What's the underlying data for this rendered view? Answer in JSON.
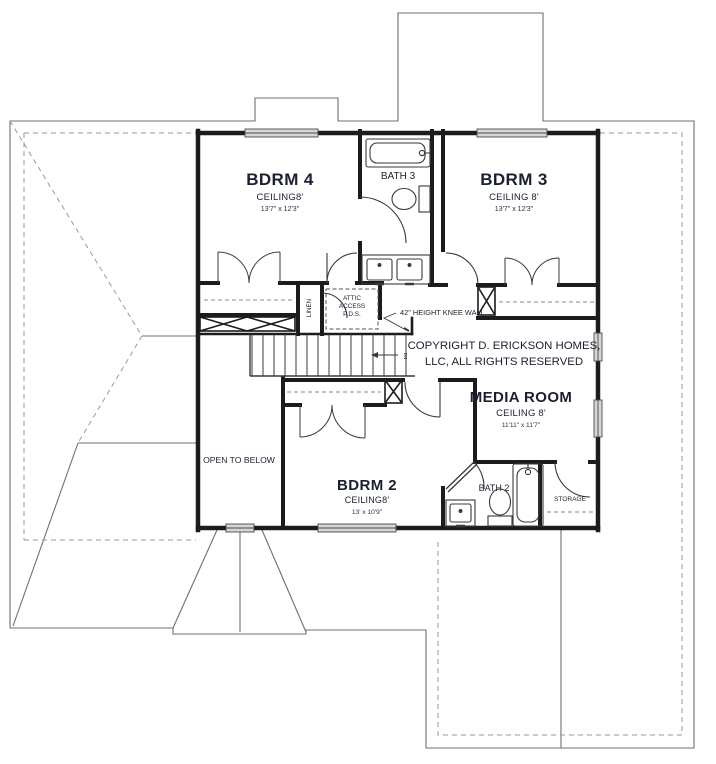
{
  "plan": {
    "rooms": {
      "bdrm4": {
        "name": "BDRM 4",
        "ceiling": "CEILING8'",
        "dims": "13'7\" x 12'3\""
      },
      "bath3": {
        "name": "BATH 3"
      },
      "bdrm3": {
        "name": "BDRM 3",
        "ceiling": "CEILING 8'",
        "dims": "13'7\" x 12'3\""
      },
      "media": {
        "name": "MEDIA ROOM",
        "ceiling": "CEILING 8'",
        "dims": "11'11\" x 11'7\""
      },
      "bdrm2": {
        "name": "BDRM 2",
        "ceiling": "CEILING8'",
        "dims": "13' x 10'9\""
      },
      "bath2": {
        "name": "BATH 2"
      },
      "storage": {
        "name": "STORAGE"
      },
      "open_below": {
        "name": "OPEN TO BELOW"
      },
      "linen": {
        "name": "LINEN"
      }
    },
    "annotations": {
      "attic_line1": "ATTIC",
      "attic_line2": "ACCESS",
      "attic_line3": "P.D.S.",
      "knee_wall": "42\" HEIGHT KNEE WALL",
      "copyright_line1": "COPYRIGHT D. ERICKSON HOMES,",
      "copyright_line2": "LLC, ALL RIGHTS RESERVED",
      "stair_direction": "DN"
    },
    "colors": {
      "wall": "#1c1c1e",
      "thin_line": "#3a3a3c",
      "roof_line": "#6f6f71",
      "roof_dash": "#9a9a9c",
      "window_fill": "#d6d6d6",
      "text": "#1a2030"
    }
  }
}
